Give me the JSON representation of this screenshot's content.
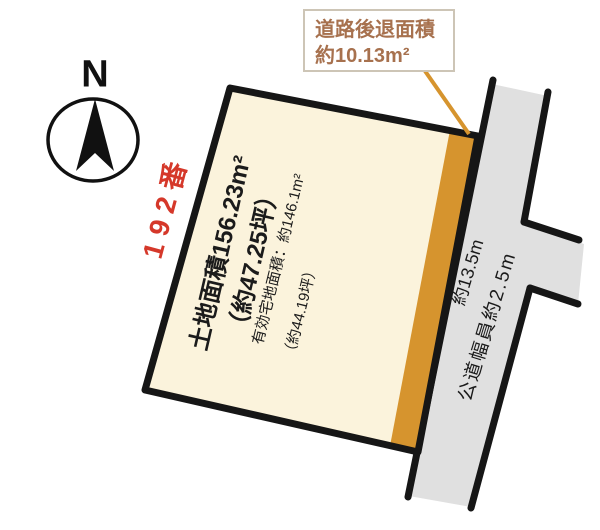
{
  "compass": {
    "label": "N"
  },
  "lot": {
    "number": "192番",
    "area_line1": "土地面積156.23m²",
    "area_line2": "（約47.25坪）",
    "effective_area_line1": "有効宅地面積：約146.1m²",
    "effective_area_line2": "（約44.19坪）"
  },
  "setback_callout": {
    "line1": "道路後退面積",
    "line2": "約10.13m²"
  },
  "road": {
    "length_label": "約13.5m",
    "width_label": "公道幅員約2.5m"
  },
  "colors": {
    "plot_fill": "#FBF3DC",
    "setback_fill": "#D6942E",
    "road_fill": "#E0E0E0",
    "outline": "#161616",
    "lot_red": "#D5382A",
    "callout_text": "#A7714E",
    "callout_border": "#CDC5B6",
    "label_dark": "#1B1B1B"
  }
}
